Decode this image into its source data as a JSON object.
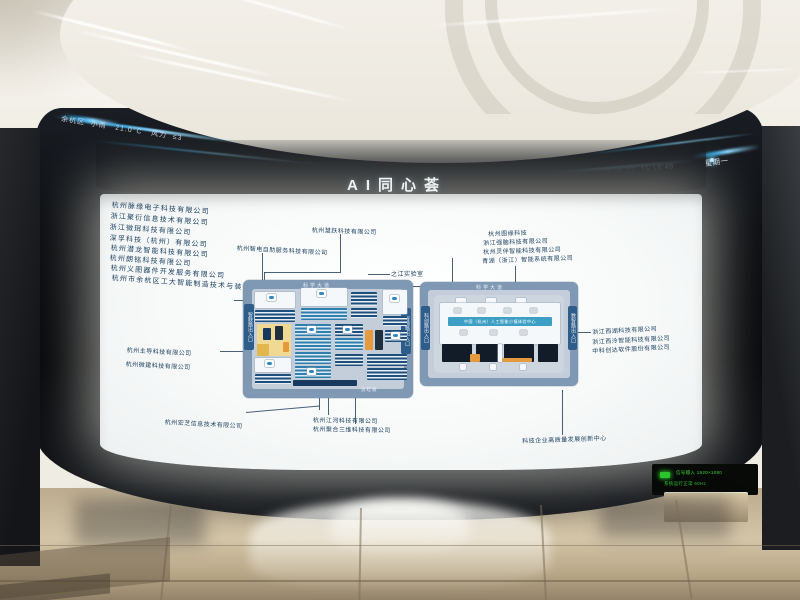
{
  "weather": {
    "district": "余杭区",
    "condition": "小雨",
    "temperature": "21.0°C",
    "wind_label": "风力",
    "wind_value": "≤3"
  },
  "header": {
    "title": "AI同心荟"
  },
  "datetime": {
    "date": "2024-05-27",
    "time": "15:18:48",
    "weekday": "星期一"
  },
  "companies": {
    "left_column": [
      "杭州脉缘电子科技有限公司",
      "浙江聚衍信息技术有限公司",
      "浙江微珥科技有限公司",
      "深孚科技（杭州）有限公司",
      "杭州潜龙智能科技有限公司",
      "杭州朗铭科技有限公司",
      "杭州义图器件开发服务有限公司",
      "杭州市余杭区工大智能制造技术与装备研究所"
    ],
    "top_middle": [
      "杭州智电自助服务科技有限公司",
      "杭州慧跃科技有限公司"
    ],
    "lab": "之江实验室",
    "right_top": [
      "杭州图缘科技",
      "浙江强脑科技有限公司",
      "杭州灵伴智能科技有限公司",
      "青湖（浙江）智能系统有限公司"
    ],
    "right_side": [
      "浙江西湖科技有限公司",
      "浙江西泠智能科技有限公司",
      "中科创达软件股份有限公司"
    ],
    "left_mid": [
      "杭州主导科技有限公司",
      "杭州微建科技有限公司"
    ],
    "bottom_left": "杭州宏芝信息技术有限公司",
    "bottom_center": [
      "杭州江河科技有限公司",
      "杭州聚合三维科技有限公司"
    ],
    "bottom_right": "科技企业高质量发展创新中心"
  },
  "maps": {
    "left": {
      "road_top": "科学大道",
      "entrance_left": "智联路出入口",
      "entrance_right": "智源路出入口",
      "road_bottom": "良睦路"
    },
    "right": {
      "road_top": "科学大道",
      "entrance_left": "科创路出入口",
      "entrance_right": "数智路出入口",
      "banner": "中国（杭州）人工智能小镇体验中心"
    }
  },
  "status_panel": {
    "line1": "信号输入 1920×1080",
    "line2": "系统运行正常 60Hz"
  },
  "colors": {
    "accent_glow": "#3fb6f0",
    "map_ring": "#7f98b4",
    "building_navy": "#1d4f7c",
    "building_teal": "#2f7fae",
    "road_yellow": "#efd993",
    "accent_orange": "#e59a3e",
    "label_text": "#173a5a",
    "status_green": "#35d435"
  }
}
